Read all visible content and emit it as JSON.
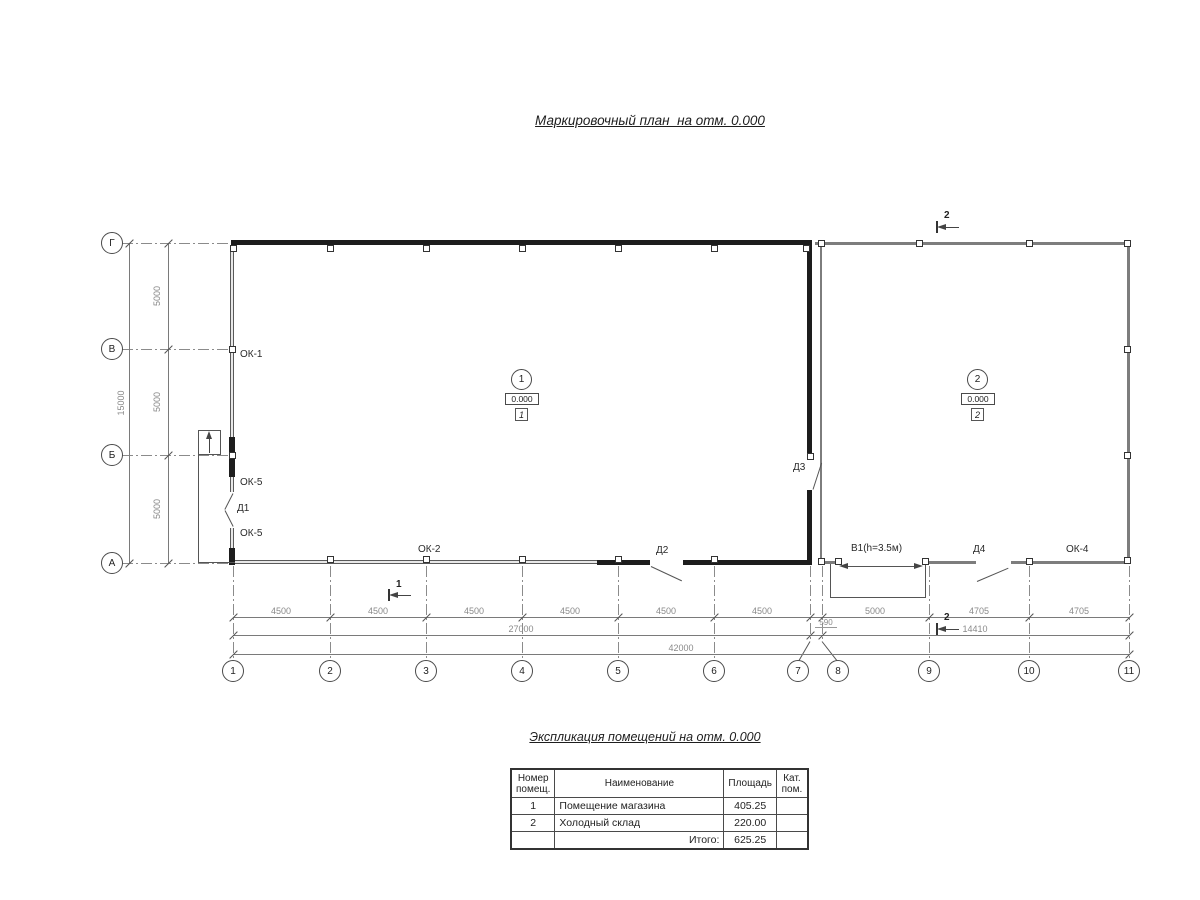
{
  "title": "Маркировочный план  на отм. 0.000",
  "axis_rows": [
    "Г",
    "В",
    "Б",
    "А"
  ],
  "axis_cols": [
    "1",
    "2",
    "3",
    "4",
    "5",
    "6",
    "7",
    "8",
    "9",
    "10",
    "11"
  ],
  "dims": {
    "v_segments": [
      "5000",
      "5000",
      "5000"
    ],
    "v_total": "15000",
    "row1_left": [
      "4500",
      "4500",
      "4500",
      "4500",
      "4500",
      "4500"
    ],
    "row1_right": [
      "5000",
      "4705",
      "4705"
    ],
    "gap": "590",
    "row2_left": "27000",
    "row2_right": "14410",
    "row3_total": "42000"
  },
  "rooms": [
    {
      "number": "1",
      "elevation": "0.000",
      "type_tag": "1"
    },
    {
      "number": "2",
      "elevation": "0.000",
      "type_tag": "2"
    }
  ],
  "marks": {
    "ok1": "ОК-1",
    "ok5_upper": "ОК-5",
    "d1": "Д1",
    "ok5_lower": "ОК-5",
    "ok2": "ОК-2",
    "d2": "Д2",
    "d3": "Д3",
    "v1": "В1(h=3.5м)",
    "d4": "Д4",
    "ok4": "ОК-4"
  },
  "sections": {
    "sec2_top": "2",
    "sec1_bottom": "1",
    "sec2_bottom": "2"
  },
  "schedule": {
    "title": "Экспликация помещений на отм. 0.000",
    "col_num": "Номер\nпомещ.",
    "col_name": "Наименование",
    "col_area": "Площадь",
    "col_cat": "Кат.\nпом.",
    "rows": [
      {
        "num": "1",
        "name": "Помещение магазина",
        "area": "405.25",
        "cat": ""
      },
      {
        "num": "2",
        "name": "Холодный склад",
        "area": "220.00",
        "cat": ""
      }
    ],
    "total_label": "Итого:",
    "total_area": "625.25"
  }
}
